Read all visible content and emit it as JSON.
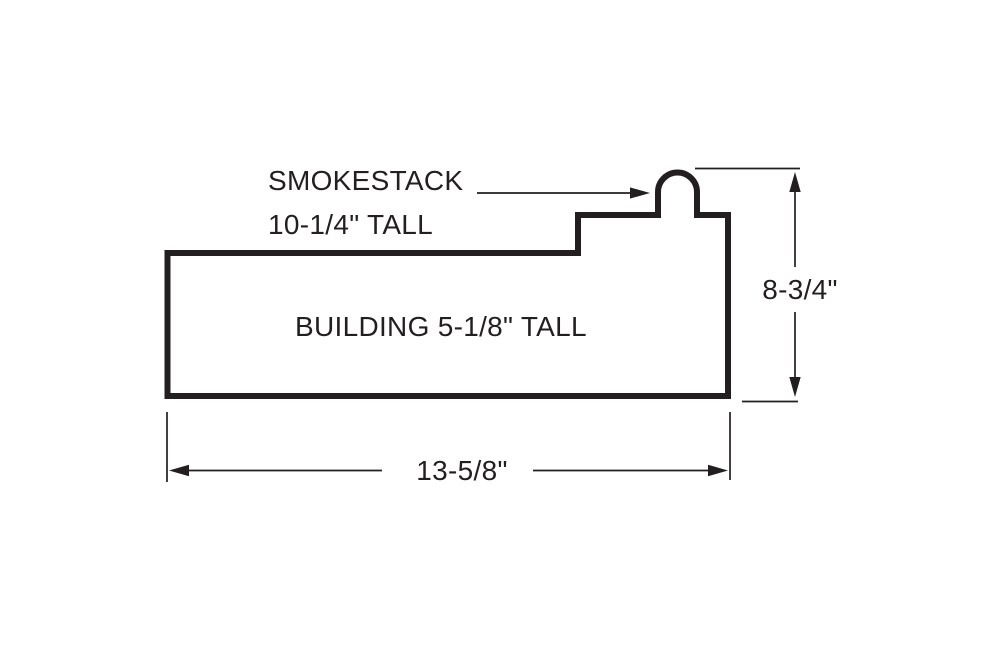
{
  "diagram": {
    "type": "dimensioned-technical-drawing",
    "colors": {
      "ink": "#231f20",
      "background": "#ffffff"
    },
    "callout": {
      "line1": "SMOKESTACK",
      "line2": "10-1/4\" TALL"
    },
    "building_label": "BUILDING 5-1/8\" TALL",
    "dimensions": {
      "overall_height": "8-3/4\"",
      "overall_width": "13-5/8\""
    }
  }
}
